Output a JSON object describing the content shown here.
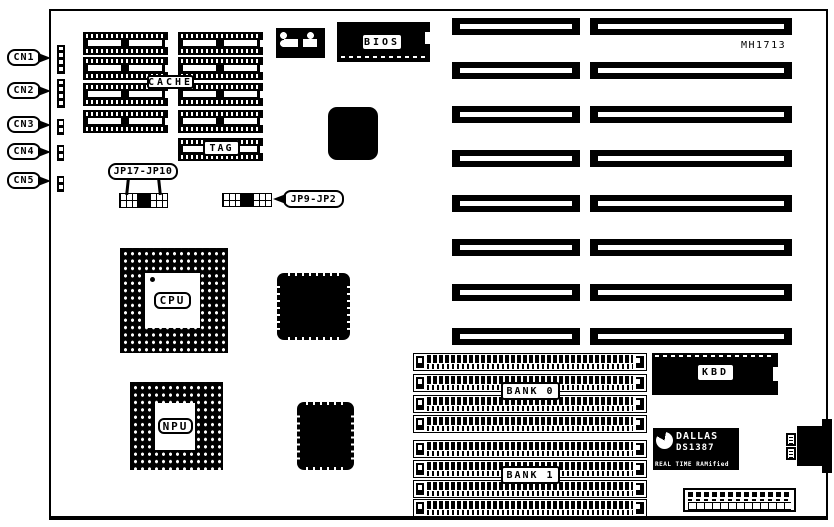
{
  "diagram": {
    "model": "MH1713"
  },
  "connector_callouts": [
    "CN1",
    "CN2",
    "CN3",
    "CN4",
    "CN5"
  ],
  "jumper_callouts": {
    "left": "JP17-JP10",
    "right": "JP9-JP2"
  },
  "chip_labels": {
    "cache": "CACHE",
    "tag": "TAG",
    "bios": "BIOS",
    "cpu": "CPU",
    "npu": "NPU",
    "kbd": "KBD"
  },
  "memory_banks": {
    "bank0": "BANK 0",
    "bank1": "BANK 1"
  },
  "rtc_chip": {
    "brand": "DALLAS",
    "part_number": "DS1387",
    "tagline": "REAL TIME RAMified"
  },
  "colors": {
    "ink": "#000000",
    "paper": "#ffffff"
  }
}
